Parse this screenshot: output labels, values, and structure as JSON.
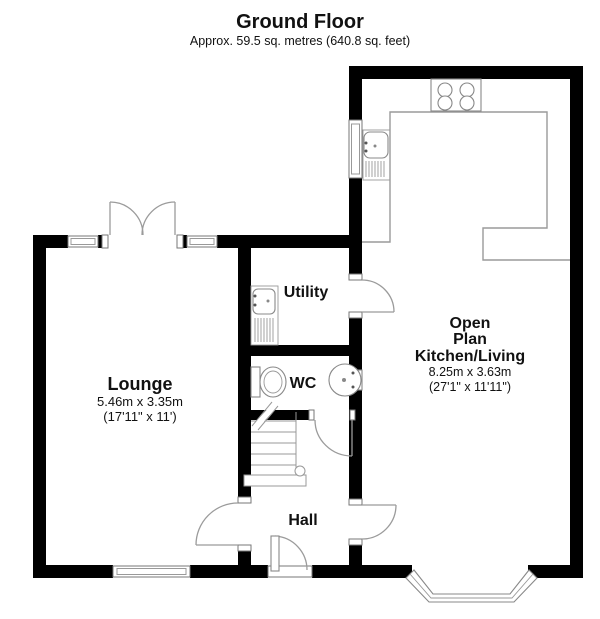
{
  "header": {
    "title": "Ground Floor",
    "subtitle": "Approx. 59.5 sq. metres (640.8 sq. feet)"
  },
  "rooms": {
    "lounge": {
      "name": "Lounge",
      "dims_metric": "5.46m x 3.35m",
      "dims_imperial": "(17'11\" x 11')"
    },
    "utility": {
      "name": "Utility"
    },
    "wc": {
      "name": "WC"
    },
    "hall": {
      "name": "Hall"
    },
    "kitchen_living": {
      "name_line1": "Open",
      "name_line2": "Plan",
      "name_line3": "Kitchen/Living",
      "dims_metric": "8.25m x 3.63m",
      "dims_imperial": "(27'1\" x 11'11\")"
    }
  },
  "fixtures": [
    "staircase",
    "kitchen-sink",
    "utility-sink",
    "hob",
    "kitchen-counter",
    "toilet",
    "wash-basin",
    "bay-window",
    "french-doors",
    "front-door"
  ],
  "colors": {
    "wall": "#000000",
    "background": "#ffffff",
    "fixture_outline": "#888888",
    "door_arc": "#9b9b9b",
    "counter_outline": "#9a9a9a",
    "text": "#111111"
  }
}
